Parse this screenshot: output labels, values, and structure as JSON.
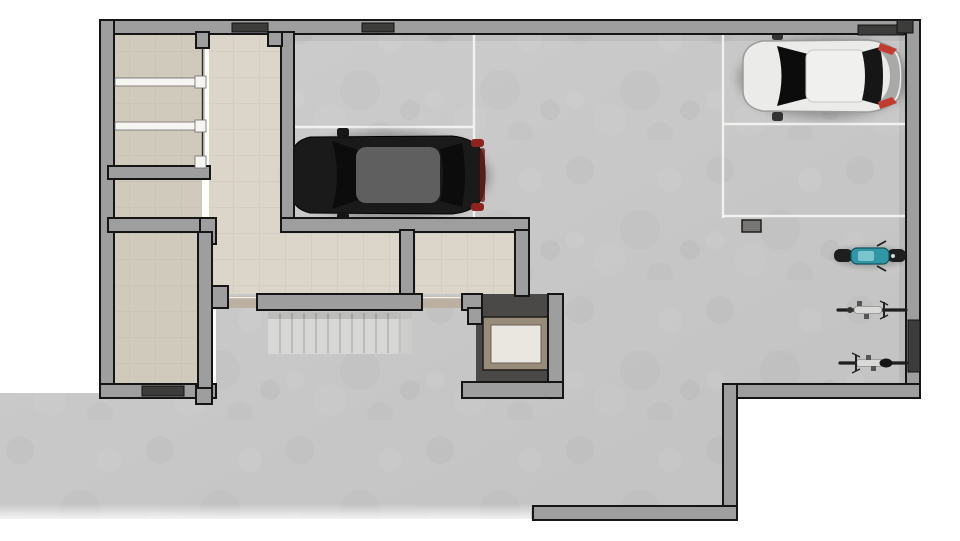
{
  "scene": {
    "title": "Basement garage floor plan — top-down 3D architectural render",
    "level": "Underground parking / storage level",
    "visible_text": "none"
  },
  "palette": {
    "page_bg": "#ffffff",
    "concrete_a": "#cdcdcd",
    "concrete_b": "#c2c2c2",
    "tile_light": "#dbd5ca",
    "tile_dark": "#d0cabd",
    "tile_line": "#a89d8c",
    "wall_fill": "#9e9e9e",
    "wall_outline": "#151515",
    "dark_opening": "#3c3c3a",
    "parking_line": "#f4f4f2",
    "stair_fill": "#d7d7d5",
    "stair_tread": "#b4b4b2",
    "elev_shaft": "#4a4947",
    "elev_frame": "#978b7a",
    "elev_cab": "#eae7e1",
    "shelf_white": "#f6f5f2",
    "threshold": "#b9ad9d",
    "drain": "#777674",
    "car_black": "#1a1a1a",
    "car_black_roof": "#5f5f5f",
    "glass": "#0c0c0c",
    "tail_red": "#8e2420",
    "car_white": "#ebebe9",
    "car_white_trim": "#9b9b99",
    "tail_red2": "#c23b2e",
    "moped_teal": "#2f97a5",
    "moped_dark": "#15535c",
    "bike_frame": "#d9d9d7",
    "bike_dark": "#1e1e1e"
  },
  "rooms": [
    {
      "id": "storage-shelves",
      "label": "Storage room with white shelving racks"
    },
    {
      "id": "storage-small",
      "label": "Small storage room"
    },
    {
      "id": "storage-large",
      "label": "Large storage room with exterior door"
    },
    {
      "id": "corridor",
      "label": "Tiled corridor"
    },
    {
      "id": "hall",
      "label": "Tiled hall"
    },
    {
      "id": "lobby-room",
      "label": "Tiled lobby room beside elevator"
    },
    {
      "id": "garage",
      "label": "Open parking garage with concrete floor"
    },
    {
      "id": "staircase",
      "label": "Staircase"
    },
    {
      "id": "elevator",
      "label": "Elevator with bronze-framed cab"
    },
    {
      "id": "apron",
      "label": "Concrete driveway apron / ramp outside garage opening"
    }
  ],
  "vehicles": [
    {
      "id": "black-sedan",
      "type": "car",
      "color": "black",
      "facing": "left",
      "location": "lower marked space, left garage bay"
    },
    {
      "id": "white-hatchback",
      "type": "car",
      "color": "white",
      "facing": "left",
      "location": "upper marked space, right bay near wall"
    },
    {
      "id": "teal-scooter",
      "type": "motor scooter",
      "color": "teal",
      "location": "right wall, top position"
    },
    {
      "id": "bicycle-1",
      "type": "bicycle",
      "location": "right wall, middle position"
    },
    {
      "id": "bicycle-2",
      "type": "bicycle",
      "location": "right wall, bottom position"
    }
  ],
  "parking": {
    "marked_spaces": 4,
    "occupied": 2,
    "empty": 2,
    "line_color": "#f4f4f2"
  }
}
